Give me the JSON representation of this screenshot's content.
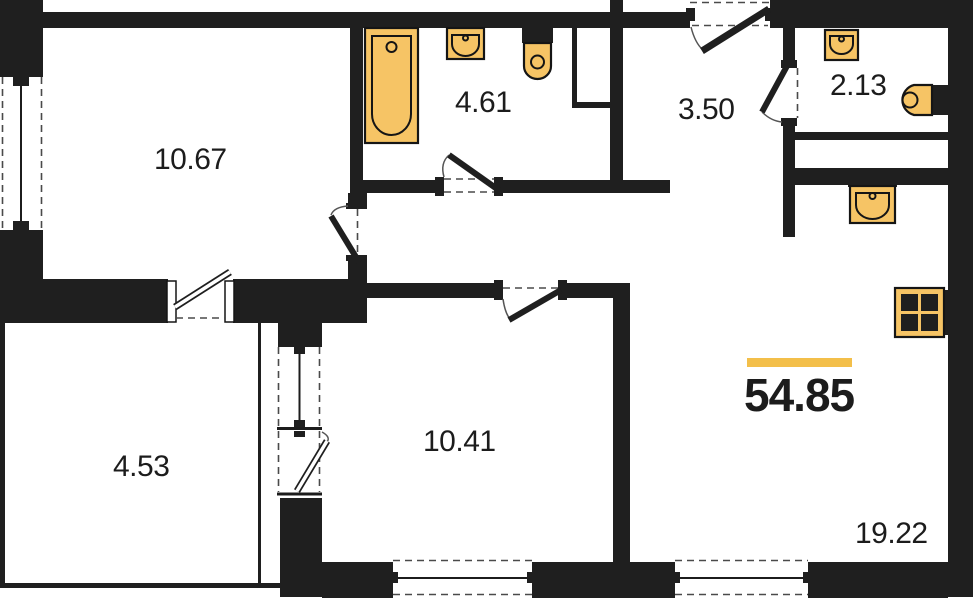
{
  "plan": {
    "type": "apartment-floor-plan",
    "total_area": "54.85",
    "rooms": [
      {
        "name": "room-top-left",
        "area": "10.67"
      },
      {
        "name": "bathroom",
        "area": "4.61"
      },
      {
        "name": "hallway",
        "area": "3.50"
      },
      {
        "name": "wc",
        "area": "2.13"
      },
      {
        "name": "balcony",
        "area": "4.53"
      },
      {
        "name": "bedroom",
        "area": "10.41"
      },
      {
        "name": "living-kitchen",
        "area": "19.22"
      }
    ],
    "fixtures": [
      "bathtub-icon",
      "sink-icon",
      "toilet-icon",
      "sink-icon",
      "washbasin-icon",
      "kitchen-sink-icon",
      "stove-icon"
    ],
    "colors": {
      "walls": "#1f1f1f",
      "fixtures": "#f6c465",
      "fixture_outline": "#151515",
      "highlight": "#f3bf4a",
      "dash": "#4a4a4a",
      "text": "#1c1c1c",
      "background": "#ffffff"
    }
  }
}
